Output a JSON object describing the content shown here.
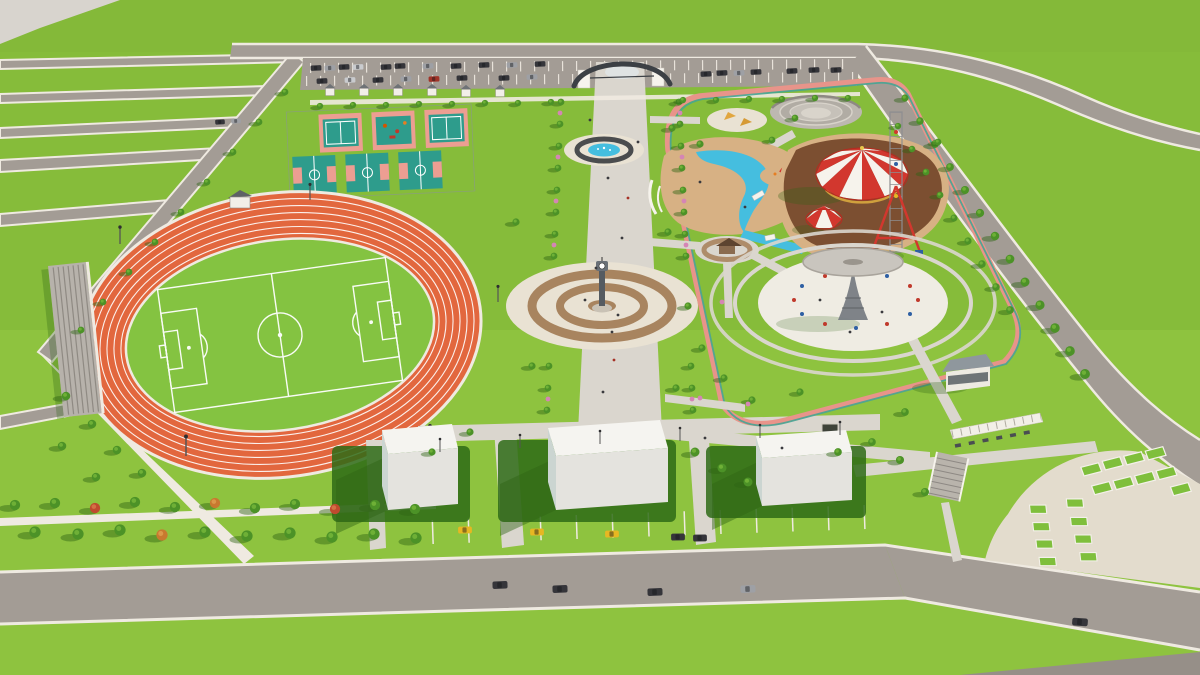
{
  "scene": {
    "type": "3d-architectural-render",
    "subject": "Aerial 3D render of a public park master plan with athletics stadium, sports courts, central promenade, amusement rides and parking",
    "regions": [
      {
        "name": "north-parking",
        "desc": "parking lot with parked cars"
      },
      {
        "name": "entrance-arch",
        "desc": "curved gateway over main promenade"
      },
      {
        "name": "sports-courts",
        "desc": "tennis and basketball courts"
      },
      {
        "name": "athletics-track",
        "desc": "orange running track with soccer field"
      },
      {
        "name": "bleachers",
        "desc": "stepped stand beside track"
      },
      {
        "name": "central-promenade",
        "desc": "tree lined axis with fountain and clock-tower plaza"
      },
      {
        "name": "water-play-pools",
        "desc": "lazy river pools with sand decks"
      },
      {
        "name": "playground",
        "desc": "children playground"
      },
      {
        "name": "amphitheater",
        "desc": "circular open-air theater"
      },
      {
        "name": "carousel",
        "desc": "red and white striped carousel"
      },
      {
        "name": "circus-tent",
        "desc": "small striped tent"
      },
      {
        "name": "drop-tower-ride",
        "desc": "lattice tower ride with red frame"
      },
      {
        "name": "swing-carousel-ride",
        "desc": "Eiffel-tower shaped swing ride under round canopy"
      },
      {
        "name": "gazebo-plaza",
        "desc": "round plaza with gazebo and brown planting ring"
      },
      {
        "name": "jogging-loop",
        "desc": "pink jogging path with teal stripe"
      },
      {
        "name": "service-buildings",
        "desc": "three white box buildings"
      },
      {
        "name": "taxi-parking",
        "desc": "street parking with yellow taxis"
      },
      {
        "name": "south-plaza",
        "desc": "curved cream plaza with green planter beds"
      }
    ],
    "counts": {
      "white_buildings": 3,
      "taxi_cabs": 3,
      "court_rows": 2,
      "planter_beds": 17
    }
  },
  "colors": {
    "grassTop": "#86BC3A",
    "grassBot": "#9ACC47",
    "grassFar": "#83B838",
    "paleWedge": "#D8D4CE",
    "lawnDark": "#2E6B16",
    "road": "#A39C95",
    "roadDark": "#968F88",
    "curb": "#EFEAE1",
    "walk": "#DAD6CE",
    "cream": "#E9E2D3",
    "water": "#45BEDF",
    "trackOrange": "#E2673E",
    "pitch": "#84C341",
    "teal": "#2E9C8C",
    "salmon": "#EC9E92",
    "ringBrown": "#A8845F",
    "dirt": "#7C4F31",
    "sand": "#D7B184",
    "red": "#D2372E",
    "canopy": "#F6F3EC",
    "steel": "#8E8E90",
    "dark": "#3C4045",
    "taxi": "#E7B722",
    "carDark": "#35353A",
    "carGray": "#9EA0A5",
    "carSilver": "#C9CBCE",
    "disc": "#C9C5BE",
    "jogPink": "#E8948A",
    "jogTeal": "#46A493",
    "bleach": "#B7B2AB",
    "bleachLn": "#8F8A83",
    "treeG": "#4C9227",
    "treeL": "#74B53A",
    "treeRed": "#BF4A2E",
    "treeOrg": "#C8792F",
    "shadow": "#2F6414",
    "bld": "#F5F4F0",
    "bldSide": "#CBD5D1",
    "bldShade": "#E4E3DE",
    "pink": "#D585B5",
    "brown": "#8A6B4F"
  }
}
